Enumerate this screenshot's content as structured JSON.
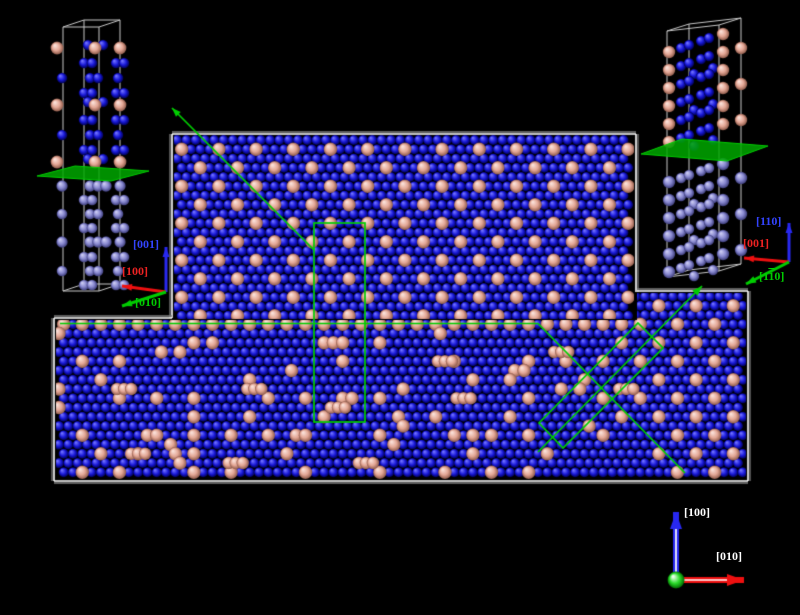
{
  "scene": {
    "description": "Atomistic simulation snapshot with two crystal slabs, interface annotations, unit-cell insets and crystallographic axes",
    "canvas": {
      "width": 800,
      "height": 615
    },
    "palette": {
      "background": "#000000",
      "atom_blue": [
        "#7070FF",
        "#1818D8",
        "#000050"
      ],
      "atom_pink": [
        "#FAE0D8",
        "#E3A695",
        "#8E5A4A"
      ],
      "atom_periwinkle": [
        "#CACAF2",
        "#8787CF",
        "#3C3C7A"
      ],
      "annotation_green": "#00CE00",
      "plane_green": "#00A800",
      "wireframe_gray": "#C8C8C8",
      "border_white": "#FFFFFF",
      "border_gray": "#7E7E7E",
      "axis_blue": "#2828F0",
      "axis_red": "#EE1010",
      "axis_green": "#00CC00",
      "label_blue": "#3344FF",
      "label_red": "#EE2222",
      "label_green": "#00CC00",
      "label_white": "#FFFFFF",
      "origin_sphere": [
        "#EAFFEA",
        "#2ADD2A",
        "#006600"
      ]
    },
    "labels": {
      "inset_left": {
        "up": "[001]",
        "left": "[100]",
        "down": "[010]"
      },
      "inset_right": {
        "up": "[110]",
        "left": "[001]",
        "down_pre": "[1",
        "down_bar": "1",
        "down_post": "0]"
      },
      "viewport": {
        "up": "[100]",
        "right": "[010]"
      }
    },
    "slabs": {
      "upper": {
        "x0": 177,
        "y0": 140,
        "cols": 49,
        "rows": 20,
        "clip": [
          [
            174,
            135
          ],
          [
            634,
            135
          ],
          [
            634,
            319
          ],
          [
            174,
            319
          ]
        ]
      },
      "lower": {
        "x0": 59,
        "y0": 296.5,
        "cols": 74,
        "rows": 20,
        "step_x": 641,
        "clip": [
          [
            56,
            320
          ],
          [
            637,
            320
          ],
          [
            637,
            293
          ],
          [
            746,
            293
          ],
          [
            746,
            479
          ],
          [
            56,
            479
          ]
        ]
      },
      "borders": [
        [
          172,
          134,
          636,
          134,
          0,
          -1
        ],
        [
          172,
          134,
          172,
          318,
          -1,
          0
        ],
        [
          636,
          134,
          636,
          292,
          1,
          0
        ],
        [
          54,
          318,
          172,
          318,
          0,
          -1
        ],
        [
          54,
          318,
          54,
          481,
          -1,
          0
        ],
        [
          54,
          481,
          748,
          481,
          0,
          1
        ],
        [
          748,
          291,
          748,
          481,
          1,
          0
        ],
        [
          637,
          291,
          748,
          291,
          0,
          -1
        ]
      ]
    },
    "lattice": {
      "dx": 9.3,
      "dy": 9.25,
      "row_offset": 4.65,
      "r_blue": 5.1,
      "r_pink": 6.7,
      "disorder": {
        "seed": 7,
        "keep_regular": 0.52,
        "extra_single": 0.038,
        "triples": 10
      }
    },
    "annotations": {
      "line_width": 1.7,
      "interface_path": [
        [
          60,
          323.5
        ],
        [
          538,
          323.5
        ],
        [
          685,
          473
        ]
      ],
      "tall_rect": [
        314,
        223,
        51,
        199
      ],
      "rotated_rect": [
        [
          638,
          323
        ],
        [
          663,
          348
        ],
        [
          563,
          448
        ],
        [
          539,
          423
        ]
      ],
      "arrows": [
        {
          "from": [
            314,
            250
          ],
          "to": [
            172,
            108
          ],
          "head": 9
        },
        {
          "from": [
            538,
            452
          ],
          "to": [
            702,
            286
          ],
          "head": 10
        }
      ]
    },
    "insets": {
      "left": {
        "box": {
          "front": [
            63,
            27,
            99,
            27
          ],
          "depth": [
            21,
            -7
          ],
          "height": 264
        },
        "plane": [
          [
            37,
            176
          ],
          [
            111,
            181
          ],
          [
            149,
            171
          ],
          [
            75,
            166
          ]
        ],
        "upper_rows": [
          {
            "y": 48,
            "t": "P"
          },
          {
            "y": 63,
            "t": "B1"
          },
          {
            "y": 78,
            "t": "B2"
          },
          {
            "y": 93,
            "t": "B1"
          },
          {
            "y": 105,
            "t": "P"
          },
          {
            "y": 120,
            "t": "B1"
          },
          {
            "y": 135,
            "t": "B2"
          },
          {
            "y": 150,
            "t": "B1"
          },
          {
            "y": 162,
            "t": "P"
          }
        ],
        "lower_rows": [
          {
            "y": 186,
            "t": "C"
          },
          {
            "y": 200,
            "t": "B1"
          },
          {
            "y": 214,
            "t": "B2"
          },
          {
            "y": 228,
            "t": "B1"
          },
          {
            "y": 242,
            "t": "C"
          },
          {
            "y": 257,
            "t": "B1"
          },
          {
            "y": 271,
            "t": "B2"
          },
          {
            "y": 285,
            "t": "B1"
          }
        ],
        "row_defs": {
          "P": {
            "pink": [
              57,
              95,
              120
            ],
            "blue": [
              [
                88,
                -3
              ],
              [
                103,
                -3
              ]
            ]
          },
          "B1": {
            "blue": [
              [
                84,
                0
              ],
              [
                92,
                0
              ],
              [
                116,
                0
              ],
              [
                124,
                0
              ]
            ]
          },
          "B2": {
            "blue": [
              [
                62,
                0
              ],
              [
                90,
                0
              ],
              [
                98,
                0
              ],
              [
                118,
                0
              ]
            ]
          },
          "C": {
            "cluster": [
              62,
              90,
              98,
              106,
              120
            ]
          }
        },
        "r_big": 6.4,
        "r_small": 5.3
      },
      "right": {
        "box": {
          "front": [
            667,
            31,
            719,
            25
          ],
          "depth": [
            22,
            -7
          ],
          "height": 246
        },
        "plane": [
          [
            641,
            154
          ],
          [
            727,
            161
          ],
          [
            768,
            146
          ],
          [
            682,
            139
          ]
        ],
        "upper_layers": [
          50,
          68,
          86,
          104,
          122,
          140
        ],
        "lower_layers": [
          180,
          198,
          216,
          234,
          252,
          270
        ],
        "chain": [
          [
            "p",
            669,
            2
          ],
          [
            "b",
            681,
            -2
          ],
          [
            "b",
            689,
            -5
          ],
          [
            "b",
            701,
            -9
          ],
          [
            "b",
            709,
            -12
          ],
          [
            "p",
            723,
            -16
          ]
        ],
        "alt_chain": [
          [
            "b",
            694,
            6
          ],
          [
            "b",
            713,
            0
          ],
          [
            "p",
            741,
            -20
          ]
        ],
        "r_big": 6.2,
        "r_small": 5.2
      }
    },
    "triads": {
      "inset_left": {
        "origin": [
          166,
          292
        ],
        "lw": 3,
        "head": 7,
        "arrows": [
          {
            "to": [
              166,
              247
            ],
            "color": "axis_blue"
          },
          {
            "to": [
              122,
              286
            ],
            "color": "axis_red"
          },
          {
            "to": [
              122,
              306
            ],
            "color": "axis_green"
          }
        ]
      },
      "inset_right": {
        "origin": [
          789,
          262
        ],
        "lw": 3,
        "head": 7,
        "arrows": [
          {
            "to": [
              789,
              223
            ],
            "color": "axis_blue"
          },
          {
            "to": [
              744,
              258
            ],
            "color": "axis_red"
          },
          {
            "to": [
              746,
              284
            ],
            "color": "axis_green"
          }
        ]
      },
      "viewport": {
        "origin": [
          676,
          580
        ],
        "sphere_r": 8.5,
        "lw": 6,
        "head_len": 17,
        "head_w": 12,
        "arrows": [
          {
            "to": [
              676,
              512
            ],
            "color": "axis_blue"
          },
          {
            "to": [
              744,
              580
            ],
            "color": "axis_red"
          }
        ]
      }
    }
  }
}
